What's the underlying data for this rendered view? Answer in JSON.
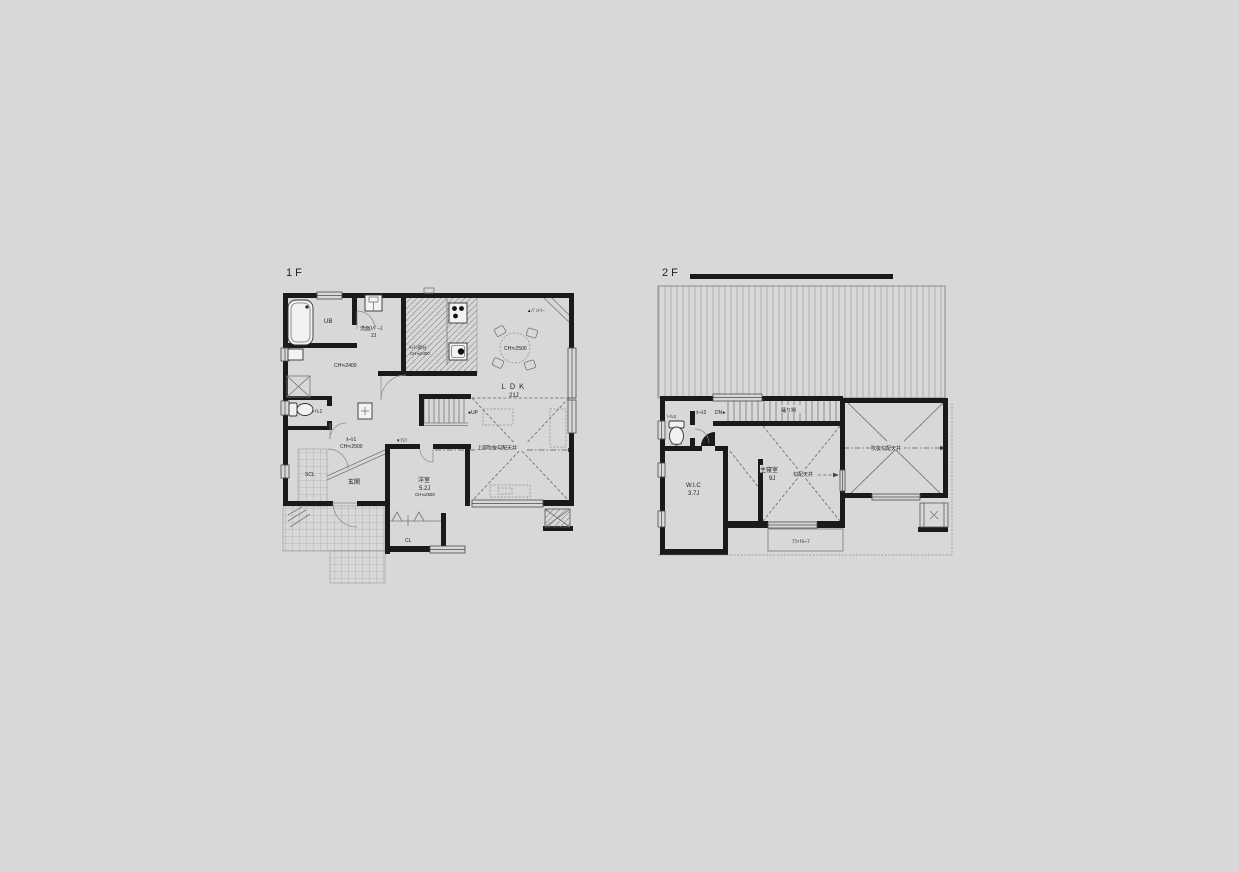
{
  "colors": {
    "background": "#d8d8d8",
    "wall": "#1a1a1a",
    "line": "#777777"
  },
  "floor1": {
    "title": "1F",
    "labels": {
      "ub": "UB",
      "washspace": "洗面ｽﾍﾟｰｽ",
      "washspace_size": "2J",
      "hall_ch": "CH≒2400",
      "kitchen_note": "ｷｯﾁﾝ部分",
      "kitchen_ch": "CH≒2400",
      "pantry": "▲ﾊﾟﾝﾄﾘｰ",
      "dining_ch": "CH≒2500",
      "ldk": "ＬＤＫ",
      "ldk_size": "21J",
      "up": "●UP",
      "void_note": "上部吹抜勾配天井",
      "handrail": "▼ﾃｽﾘ",
      "hall1": "ﾎｰﾙ1",
      "hall1_ch": "CH≒2500",
      "toilet1": "ﾄｲﾚ1",
      "scl": "SCL",
      "genkan": "玄関",
      "yoshitsu": "洋室",
      "yoshitsu_size": "5.2J",
      "yoshitsu_ch": "CH≒2500",
      "cl": "CL"
    }
  },
  "floor2": {
    "title": "2F",
    "labels": {
      "toilet2": "ﾄｲﾚ2",
      "hall2": "ﾎｰﾙ2",
      "dn": "DN●",
      "landing": "踊り場",
      "wic": "W.I.C",
      "wic_size": "3.7J",
      "bedroom": "主寝室",
      "bedroom_size": "9J",
      "sloped_ceiling": "勾配天井",
      "void_sloped_ceiling": "吹抜勾配天井",
      "flat_roof": "ﾌﾗｯﾄﾙｰﾌ"
    }
  }
}
